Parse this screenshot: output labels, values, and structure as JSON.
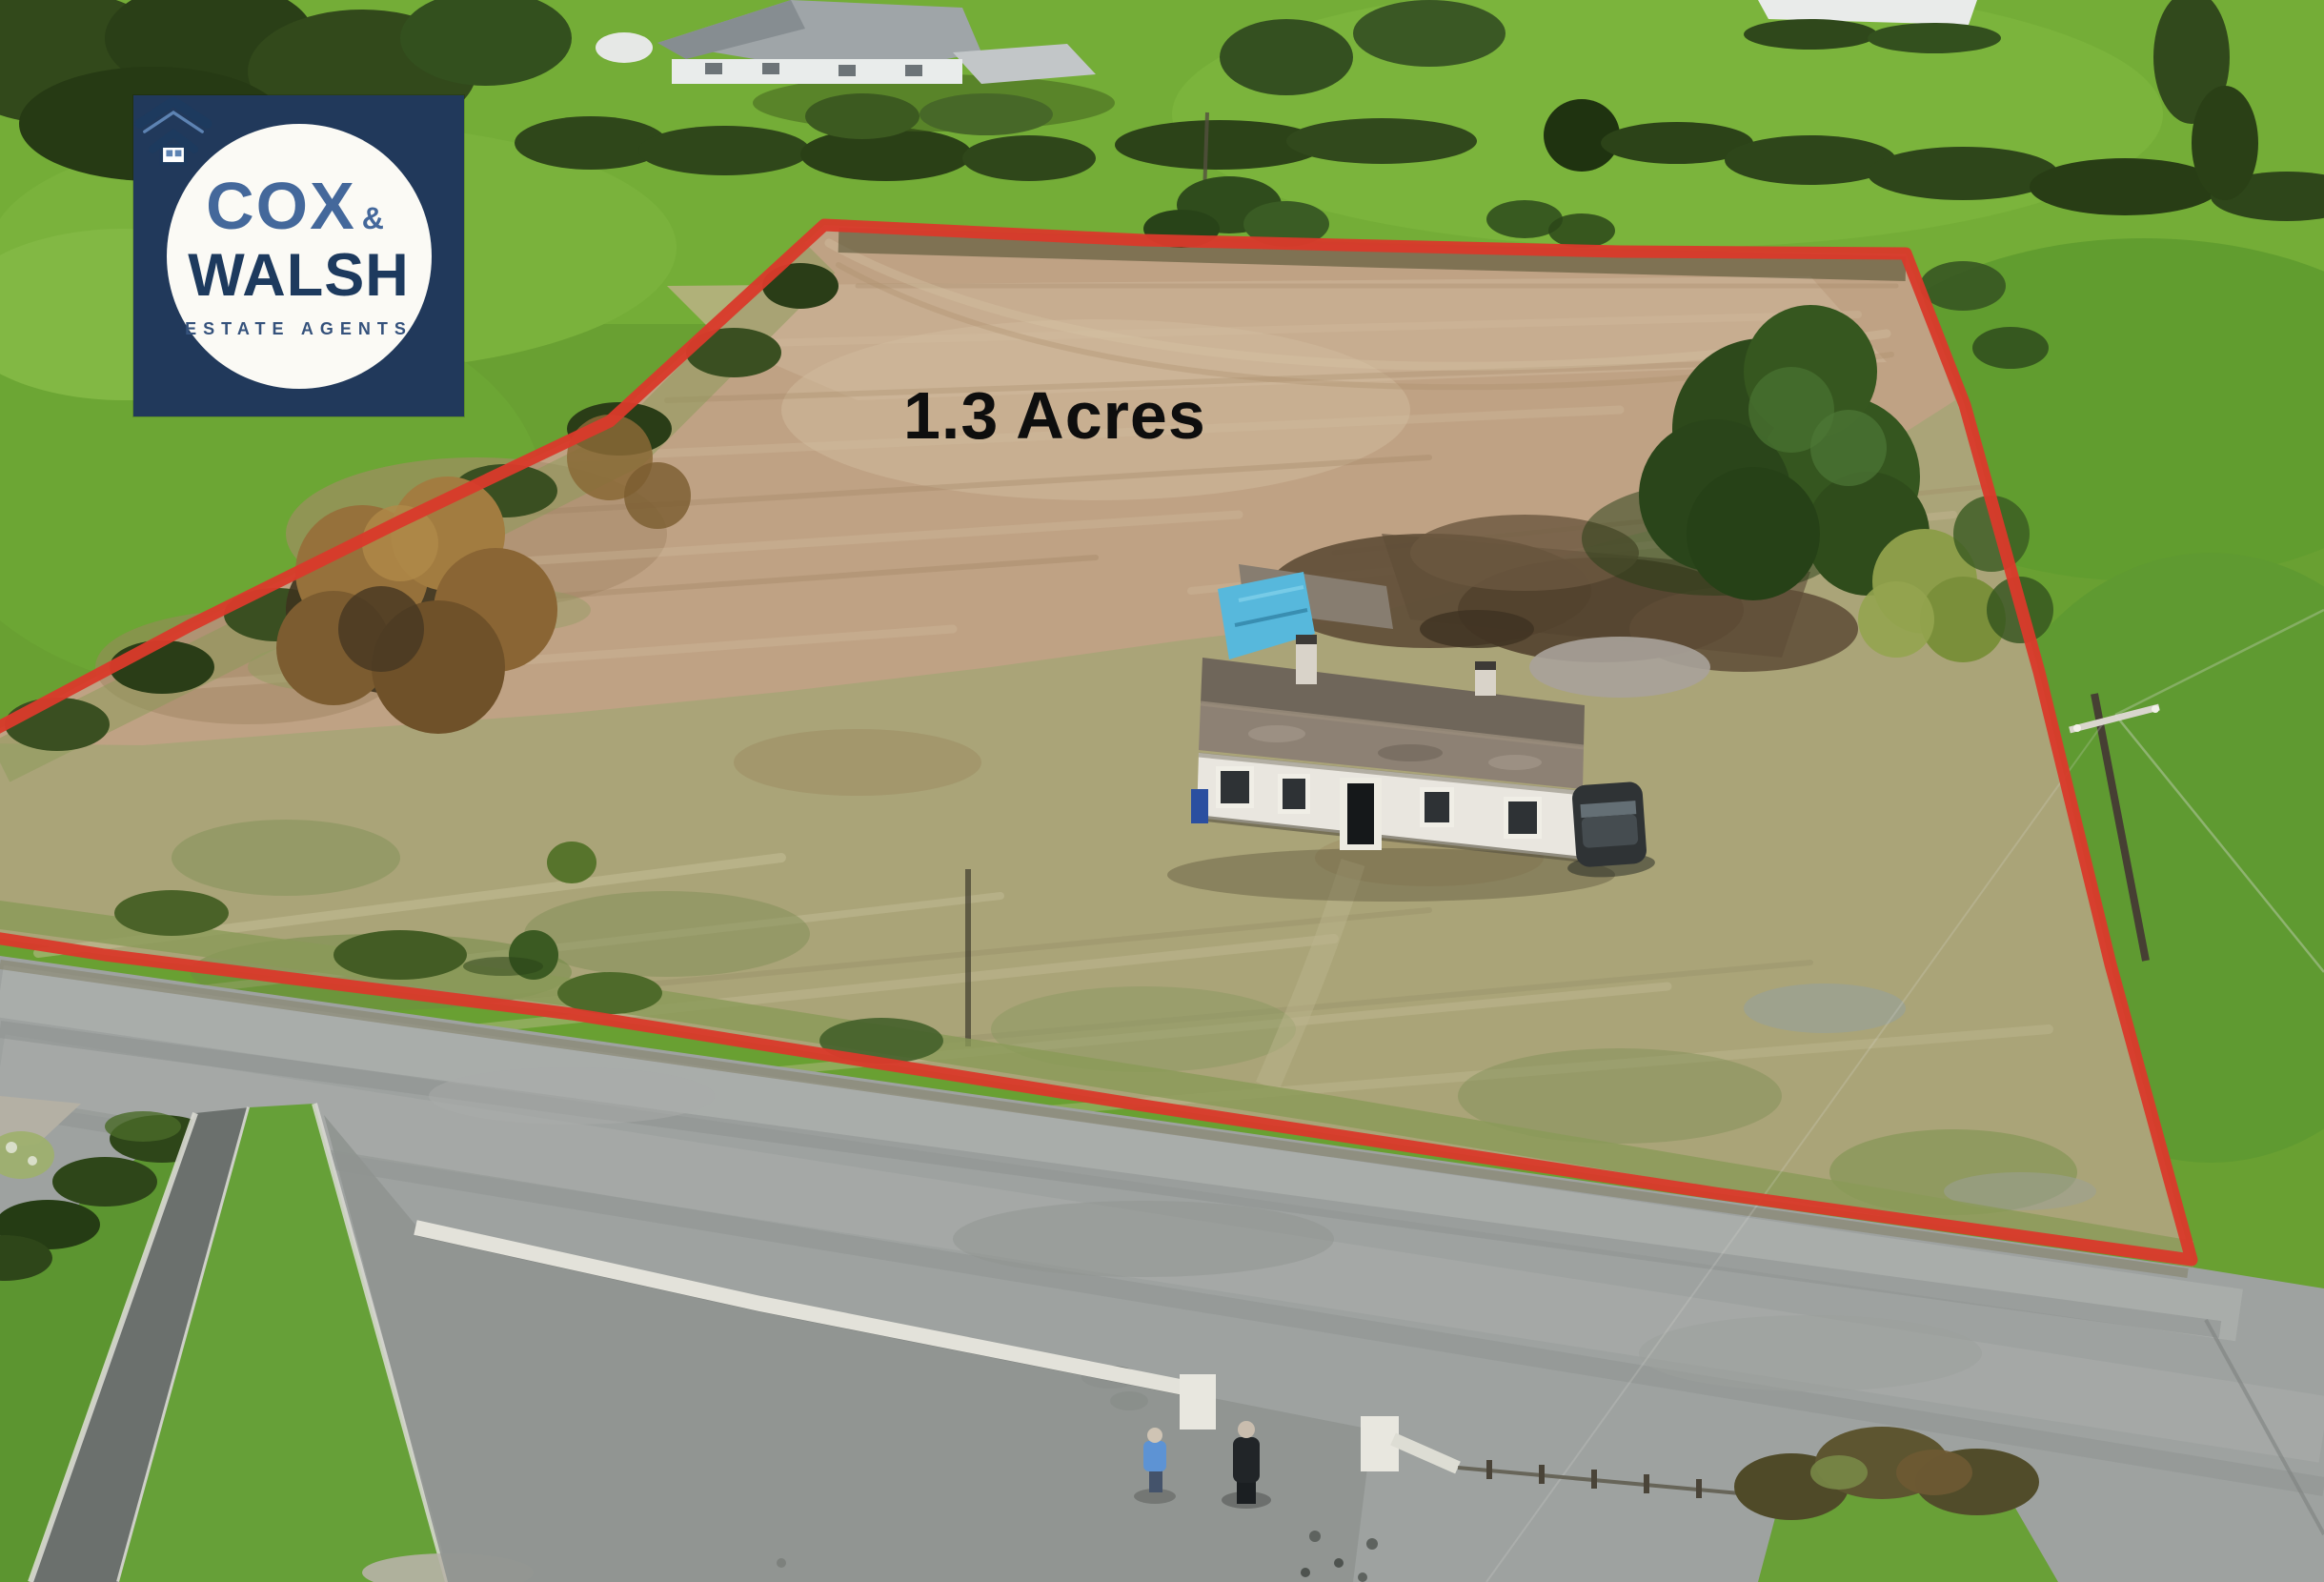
{
  "logo": {
    "cox": "COX",
    "ampersand": "&",
    "walsh": "WALSH",
    "tagline": "ESTATE AGENTS",
    "colors": {
      "background": "#21395b",
      "circle": "#fbfaf5",
      "cox": "#44689b",
      "walsh": "#1d3a5e",
      "tagline": "#35527c",
      "icon": "#1d3a5e",
      "icon_accent": "#5d83b3"
    }
  },
  "annotation": {
    "area_label": "1.3 Acres",
    "colors": {
      "label": "#0e0e0e",
      "boundary": "#d93a2b"
    }
  }
}
